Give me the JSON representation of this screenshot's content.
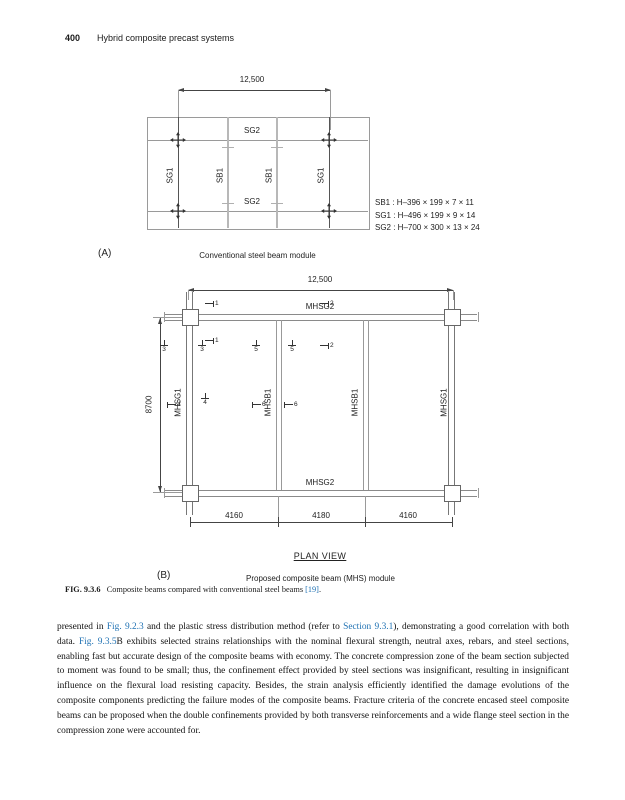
{
  "colors": {
    "link": "#2273b4",
    "line_gray": "#9a9a9a",
    "line_dark": "#444444"
  },
  "header": {
    "page_number": "400",
    "running_title": "Hybrid composite precast systems"
  },
  "figure_a": {
    "dim_top": "12,500",
    "beam_top": "SG2",
    "beam_bottom": "SG2",
    "members": [
      "SG1",
      "SB1",
      "SB1",
      "SG1"
    ],
    "legend": [
      "SB1 : H–396 × 199 × 7 × 11",
      "SG1 : H–496 × 199 × 9 × 14",
      "SG2 : H–700 × 300 × 13 × 24"
    ],
    "panel_label": "(A)",
    "panel_caption": "Conventional steel beam module"
  },
  "figure_b": {
    "dim_top": "12,500",
    "dim_left": "8700",
    "beam_top": "MHSG2",
    "beam_bottom": "MHSG2",
    "members": [
      "MHSG1",
      "MHSB1",
      "MHSB1",
      "MHSG1"
    ],
    "dims_bottom": [
      "4160",
      "4180",
      "4160"
    ],
    "section_markers": [
      "1",
      "1",
      "2",
      "2",
      "3",
      "3",
      "5",
      "5",
      "4",
      "4",
      "6",
      "6"
    ],
    "plan_view": "PLAN VIEW",
    "panel_label": "(B)",
    "panel_caption": "Proposed composite beam (MHS) module"
  },
  "figure_caption": {
    "label": "FIG. 9.3.6",
    "text": "Composite beams compared with conventional steel beams ",
    "ref": "[19]",
    "period": "."
  },
  "body": {
    "segments": [
      {
        "text": "presented in "
      },
      {
        "text": "Fig. 9.2.3",
        "link": true
      },
      {
        "text": " and the plastic stress distribution method (refer to "
      },
      {
        "text": "Section 9.3.1",
        "link": true
      },
      {
        "text": "), demonstrating a good correlation with both data. "
      },
      {
        "text": "Fig. 9.3.5",
        "link": true
      },
      {
        "text": "B exhibits selected strains relationships with the nominal flexural strength, neutral axes, rebars, and steel sections, enabling fast but accurate design of the composite beams with economy. The concrete compression zone of the beam section subjected to moment was found to be small; thus, the confinement effect provided by steel sections was insignificant, resulting in insignificant influence on the flexural load resisting capacity. Besides, the strain analysis efficiently identified the damage evolutions of the composite components predicting the failure modes of the composite beams. Fracture criteria of the concrete encased steel composite beams can be proposed when the double confinements provided by both transverse reinforcements and a wide flange steel section in the compression zone were accounted for."
      }
    ]
  }
}
